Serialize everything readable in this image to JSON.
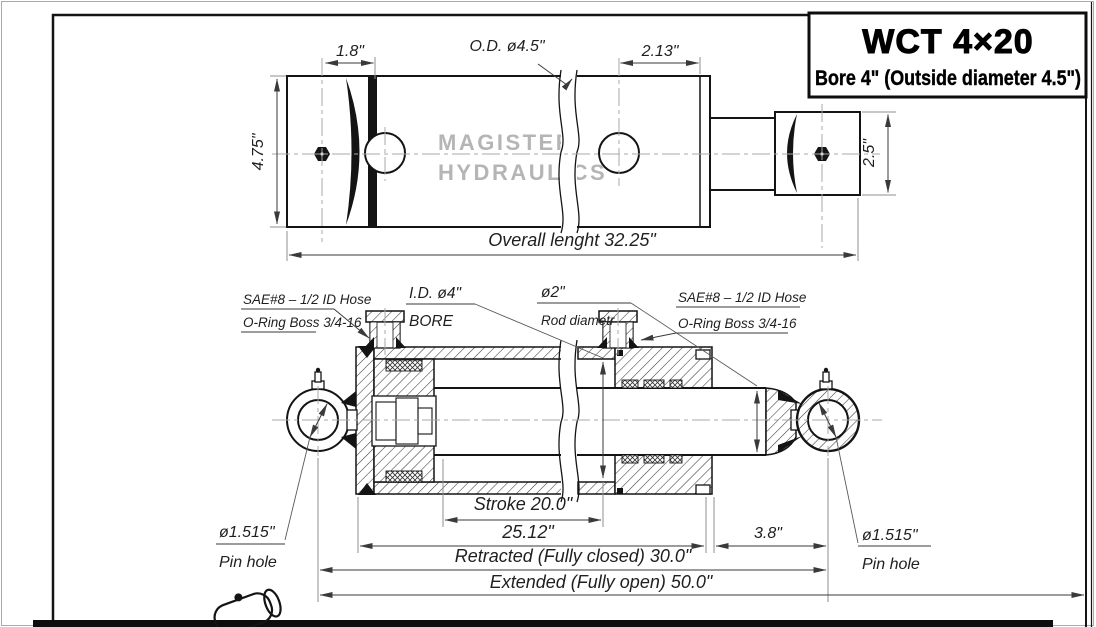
{
  "colors": {
    "background": "#ffffff",
    "line": "#141414",
    "dimension_line": "#3a3a3a",
    "watermark": "#b5b5b5"
  },
  "title_block": {
    "model": "WCT 4×20",
    "subtitle": "Bore 4\" (Outside diameter 4.5\")"
  },
  "watermark": {
    "line1": "MAGISTER",
    "line2": "HYDRAULICS"
  },
  "top_view": {
    "dim_1_8": "1.8\"",
    "dim_od": "O.D. ø4.5\"",
    "dim_2_13": "2.13\"",
    "dim_4_75": "4.75\"",
    "dim_2_5": "2.5\"",
    "dim_overall": "Overall lenght 32.25\""
  },
  "section_view": {
    "sae_left_line1": "SAE#8 – 1/2 ID Hose",
    "sae_left_line2": "O-Ring Boss 3/4-16",
    "sae_right_line1": "SAE#8 – 1/2 ID Hose",
    "sae_right_line2": "O-Ring Boss 3/4-16",
    "bore_line1": "I.D. ø4\"",
    "bore_line2": "BORE",
    "rod_line1": "ø2\"",
    "rod_line2": "Rod diametr",
    "dim_stroke": "Stroke 20.0\"",
    "dim_25_12": "25.12\"",
    "dim_3_8": "3.8\"",
    "dim_retracted": "Retracted (Fully closed) 30.0\"",
    "dim_extended": "Extended (Fully open) 50.0\"",
    "pin_left_line1": "ø1.515\"",
    "pin_left_line2": "Pin hole",
    "pin_right_line1": "ø1.515\"",
    "pin_right_line2": "Pin hole"
  }
}
